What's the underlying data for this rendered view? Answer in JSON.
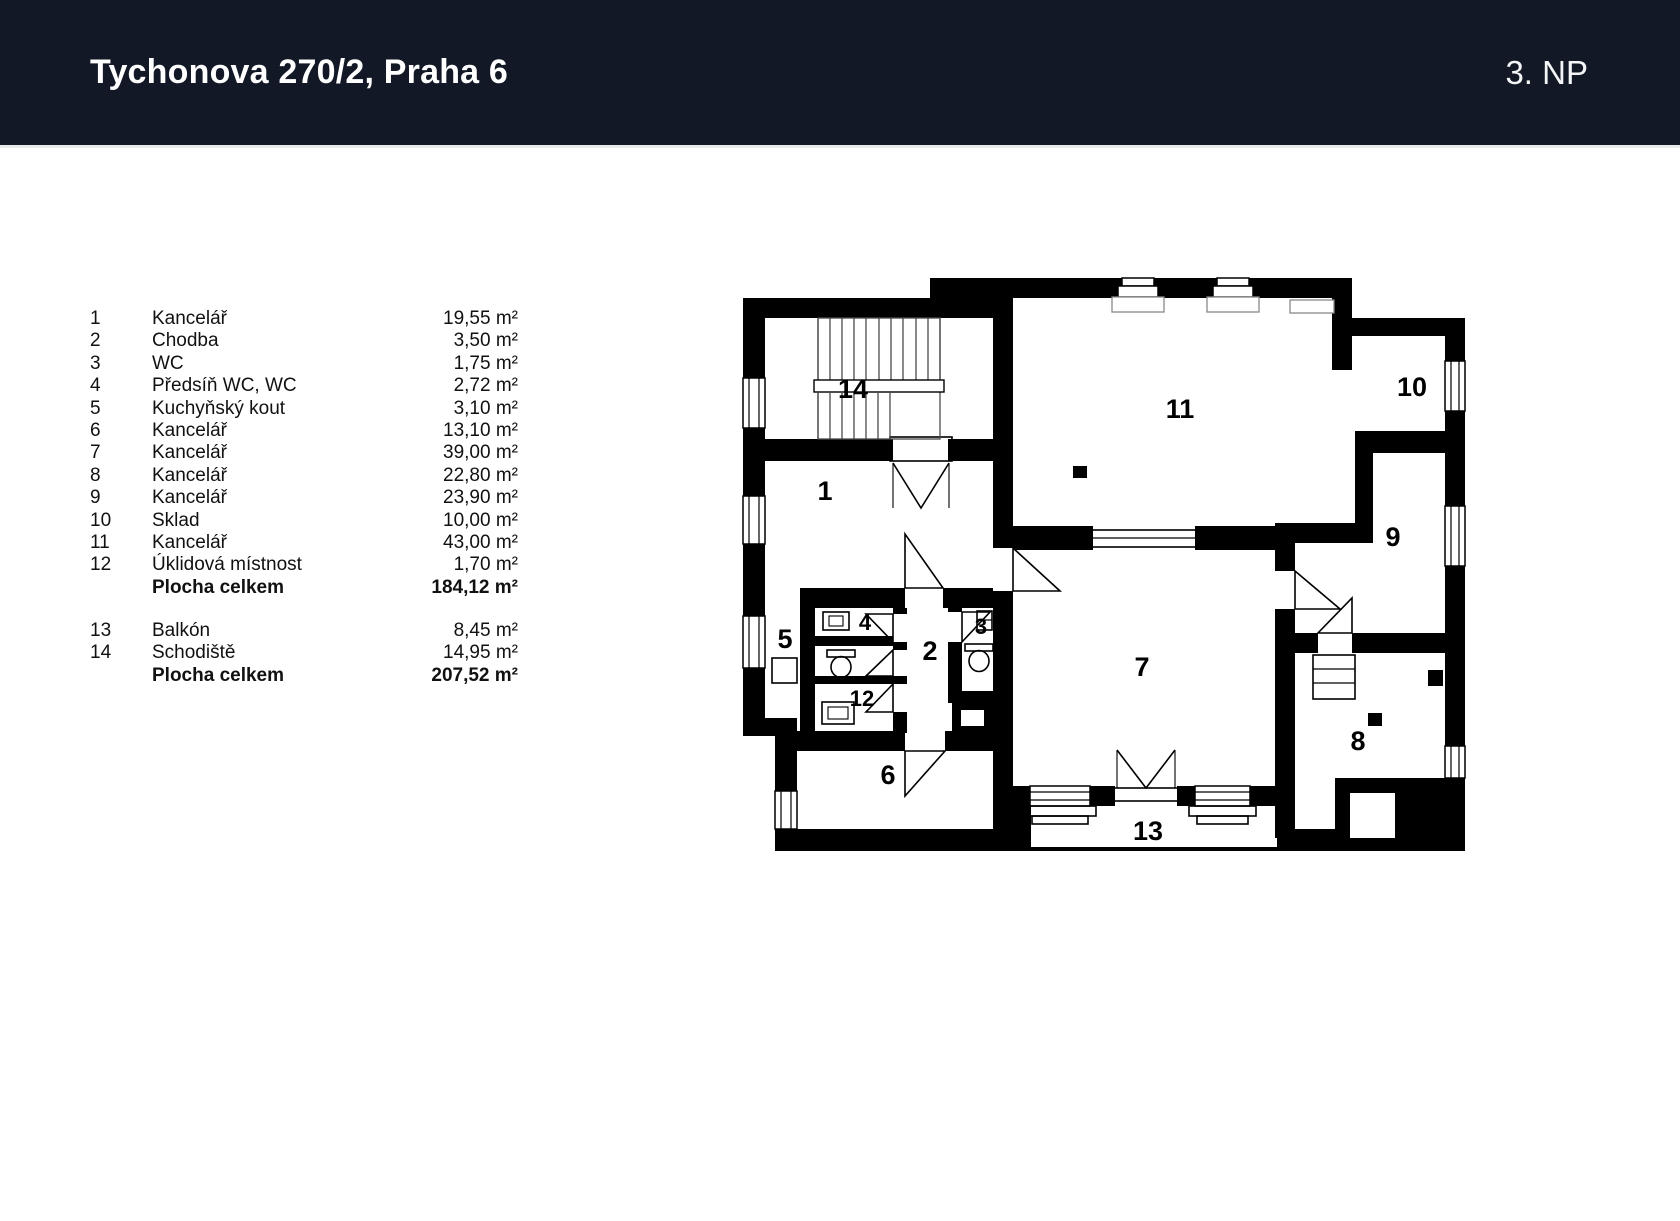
{
  "header": {
    "title": "Tychonova 270/2, Praha 6",
    "floor": "3. NP"
  },
  "legend": {
    "rows": [
      {
        "num": "1",
        "name": "Kancelář",
        "area": "19,55 m²"
      },
      {
        "num": "2",
        "name": "Chodba",
        "area": "3,50 m²"
      },
      {
        "num": "3",
        "name": "WC",
        "area": "1,75 m²"
      },
      {
        "num": "4",
        "name": "Předsíň WC, WC",
        "area": "2,72 m²"
      },
      {
        "num": "5",
        "name": "Kuchyňský kout",
        "area": "3,10 m²"
      },
      {
        "num": "6",
        "name": "Kancelář",
        "area": "13,10 m²"
      },
      {
        "num": "7",
        "name": "Kancelář",
        "area": "39,00 m²"
      },
      {
        "num": "8",
        "name": "Kancelář",
        "area": "22,80 m²"
      },
      {
        "num": "9",
        "name": "Kancelář",
        "area": "23,90 m²"
      },
      {
        "num": "10",
        "name": "Sklad",
        "area": "10,00 m²"
      },
      {
        "num": "11",
        "name": "Kancelář",
        "area": "43,00 m²"
      },
      {
        "num": "12",
        "name": "Úklidová místnost",
        "area": "1,70 m²"
      }
    ],
    "total1": {
      "num": "",
      "name": "Plocha celkem",
      "area": "184,12 m²"
    },
    "rows2": [
      {
        "num": "13",
        "name": "Balkón",
        "area": "8,45 m²"
      },
      {
        "num": "14",
        "name": "Schodiště",
        "area": "14,95 m²"
      }
    ],
    "total2": {
      "num": "",
      "name": "Plocha celkem",
      "area": "207,52 m²"
    }
  },
  "plan_labels": {
    "r1": "1",
    "r2": "2",
    "r3": "3",
    "r4": "4",
    "r5": "5",
    "r6": "6",
    "r7": "7",
    "r8": "8",
    "r9": "9",
    "r10": "10",
    "r11": "11",
    "r12": "12",
    "r13": "13",
    "r14": "14"
  },
  "colors": {
    "header_bg": "#121826",
    "header_text": "#ffffff",
    "plan_walls": "#000000"
  }
}
